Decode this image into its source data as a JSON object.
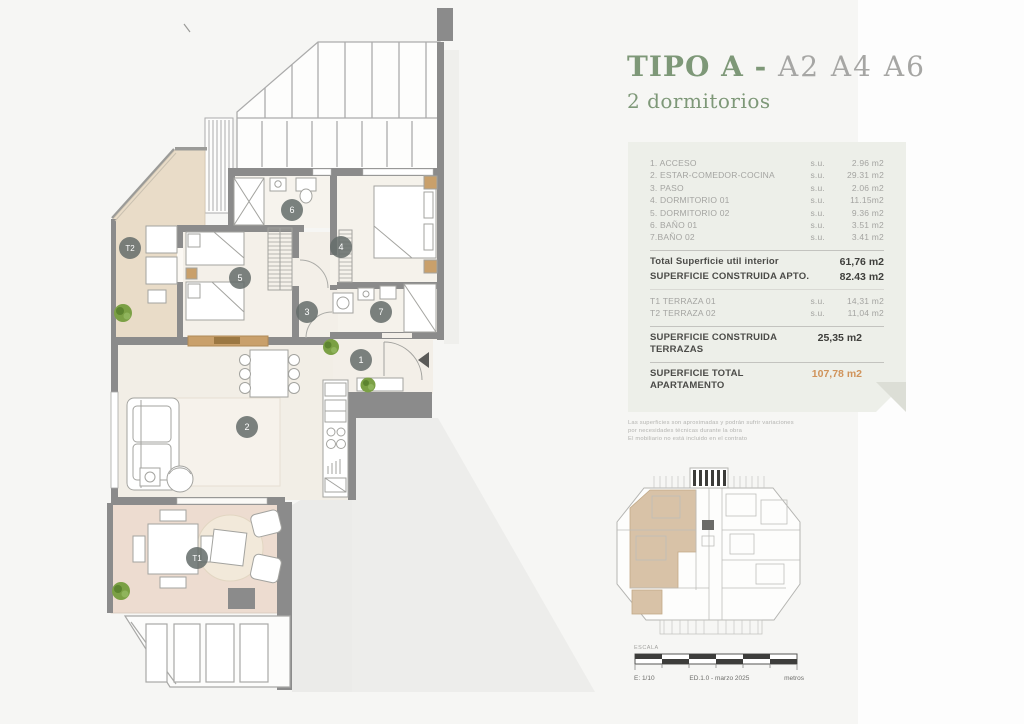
{
  "title": {
    "main": "TIPO A",
    "separator": " - ",
    "units": "A2 A4 A6",
    "subtitle": "2 dormitorios"
  },
  "summary_card": {
    "rooms": [
      {
        "label": "1. ACCESO",
        "su": "s.u.",
        "value": "2.96 m2"
      },
      {
        "label": "2. ESTAR-COMEDOR-COCINA",
        "su": "s.u.",
        "value": "29.31 m2"
      },
      {
        "label": "3. PASO",
        "su": "s.u.",
        "value": "2.06 m2"
      },
      {
        "label": "4. DORMITORIO 01",
        "su": "s.u.",
        "value": "11.15m2"
      },
      {
        "label": "5. DORMITORIO 02",
        "su": "s.u.",
        "value": "9.36 m2"
      },
      {
        "label": "6. BAÑO 01",
        "su": "s.u.",
        "value": "3.51 m2"
      },
      {
        "label": "7.BAÑO 02",
        "su": "s.u.",
        "value": "3.41 m2"
      }
    ],
    "total_util": {
      "label": "Total Superficie util interior",
      "value": "61,76 m2"
    },
    "construida_apto": {
      "label": "SUPERFICIE CONSTRUIDA APTO.",
      "value": "82.43 m2"
    },
    "terraces": [
      {
        "label": "T1 TERRAZA 01",
        "su": "s.u.",
        "value": "14,31 m2"
      },
      {
        "label": "T2 TERRAZA 02",
        "su": "s.u.",
        "value": "11,04 m2"
      }
    ],
    "construida_terrazas": {
      "label": "SUPERFICIE CONSTRUIDA TERRAZAS",
      "value": "25,35 m2"
    },
    "total_apartamento": {
      "label": "SUPERFICIE TOTAL APARTAMENTO",
      "value": "107,78 m2"
    },
    "accent_color": "#d0935a"
  },
  "disclaimer": [
    "Las superficies son aproximadas y podrán sufrir variaciones",
    "por necesidades técnicas durante la obra",
    "El mobiliario no está incluido en el contrato"
  ],
  "scale_bar": {
    "label": "ESCALA",
    "scale": "E: 1/10",
    "edition": "ED.1.0 - marzo 2025",
    "units": "metros"
  },
  "floor_plan": {
    "badges": [
      {
        "id": "1",
        "x": 361,
        "y": 360
      },
      {
        "id": "2",
        "x": 247,
        "y": 427
      },
      {
        "id": "3",
        "x": 307,
        "y": 312
      },
      {
        "id": "4",
        "x": 341,
        "y": 247
      },
      {
        "id": "5",
        "x": 240,
        "y": 278
      },
      {
        "id": "6",
        "x": 292,
        "y": 210
      },
      {
        "id": "7",
        "x": 381,
        "y": 312
      },
      {
        "id": "T1",
        "x": 197,
        "y": 558
      },
      {
        "id": "T2",
        "x": 130,
        "y": 248
      }
    ]
  }
}
